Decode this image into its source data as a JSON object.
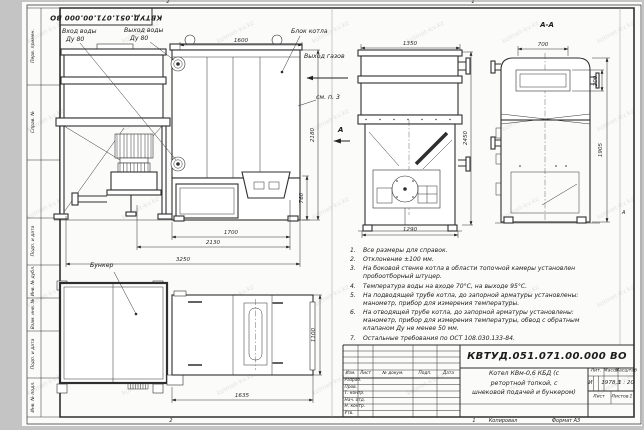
{
  "frame": {
    "stamp_rotated": "КВТУД.051.071.00.000 ВО",
    "zone_top_left": "2",
    "zone_top_right": "1",
    "zone_bottom_left": "2",
    "zone_bottom_right": "1",
    "zone_right_letter": "А",
    "margin_labels": [
      "Перв. примен.",
      "Справ. №",
      "Подп. и дата",
      "Инв. № дубл.",
      "Взам. инв. №",
      "Подп. и дата",
      "Инв. № подл."
    ]
  },
  "labels": {
    "water_inlet_line1": "Вход воды",
    "water_inlet_line2": "Ду 80",
    "water_outlet_line1": "Выход воды",
    "water_outlet_line2": "Ду 80",
    "boiler_block": "Блок котла",
    "gas_outlet": "Выход газов",
    "see_note": "см. п. 3",
    "view_arrow_letter": "А",
    "section_title": "А-А",
    "hopper": "Бункер"
  },
  "dims": {
    "top_length": "1600",
    "front_width": "1350",
    "section_top_width": "700",
    "section_window_height": "200",
    "front_height": "2450",
    "section_height": "1905",
    "block_height": "2180",
    "furnace_height": "760",
    "furnace_length": "1700",
    "base_length": "2130",
    "overall_length": "3250",
    "front_base_width": "1290",
    "plan_block_length": "1635",
    "plan_width": "1100"
  },
  "notes": {
    "items": [
      {
        "num": "1.",
        "text": "Все размеры для справок."
      },
      {
        "num": "2.",
        "text": "Отклонение ±100 мм."
      },
      {
        "num": "3.",
        "text": "На боковой стенке котла в области топочной камеры установлен пробоотборный штуцер."
      },
      {
        "num": "4.",
        "text": "Температура воды на входе 70°С, на выходе 95°С."
      },
      {
        "num": "5.",
        "text": "На подводящей трубе котла, до запорной арматуры установлены: манометр, прибор для измерения температуры."
      },
      {
        "num": "6.",
        "text": "На отводящей трубе котла, до запорной арматуры установлены: манометр, прибор для измерения температуры, обвод с обратным клапаном Ду не менее 50 мм."
      },
      {
        "num": "7.",
        "text": "Остальные требования по ОСТ 108.030.133-84."
      }
    ]
  },
  "title_block": {
    "doc_number": "КВТУД.051.071.00.000 ВО",
    "name_line1": "Котел КВм-0,6 КБД (с",
    "name_line2": "ретортной топкой, с",
    "name_line3": "шнековой подачей и бункером)",
    "col_izm": "Изм.",
    "col_list": "Лист",
    "col_doc": "№ докум.",
    "col_sign": "Подп.",
    "col_date": "Дата",
    "row_labels": [
      "Разраб.",
      "Пров.",
      "Т. контр.",
      "Нач. отд.",
      "Н. контр.",
      "Утв."
    ],
    "lit_label": "Лит.",
    "lit_value": "И",
    "mass_label": "Масса",
    "mass_value": "1978,3",
    "scale_label": "Масштаб",
    "scale_value": "1 : 20",
    "sheet_label": "Лист",
    "sheets_label": "Листов",
    "sheets_value": "1"
  },
  "footer": {
    "copied_by": "Копировал",
    "format": "Формат А3"
  },
  "watermark": {
    "text": "kolmet-kv.kz"
  }
}
